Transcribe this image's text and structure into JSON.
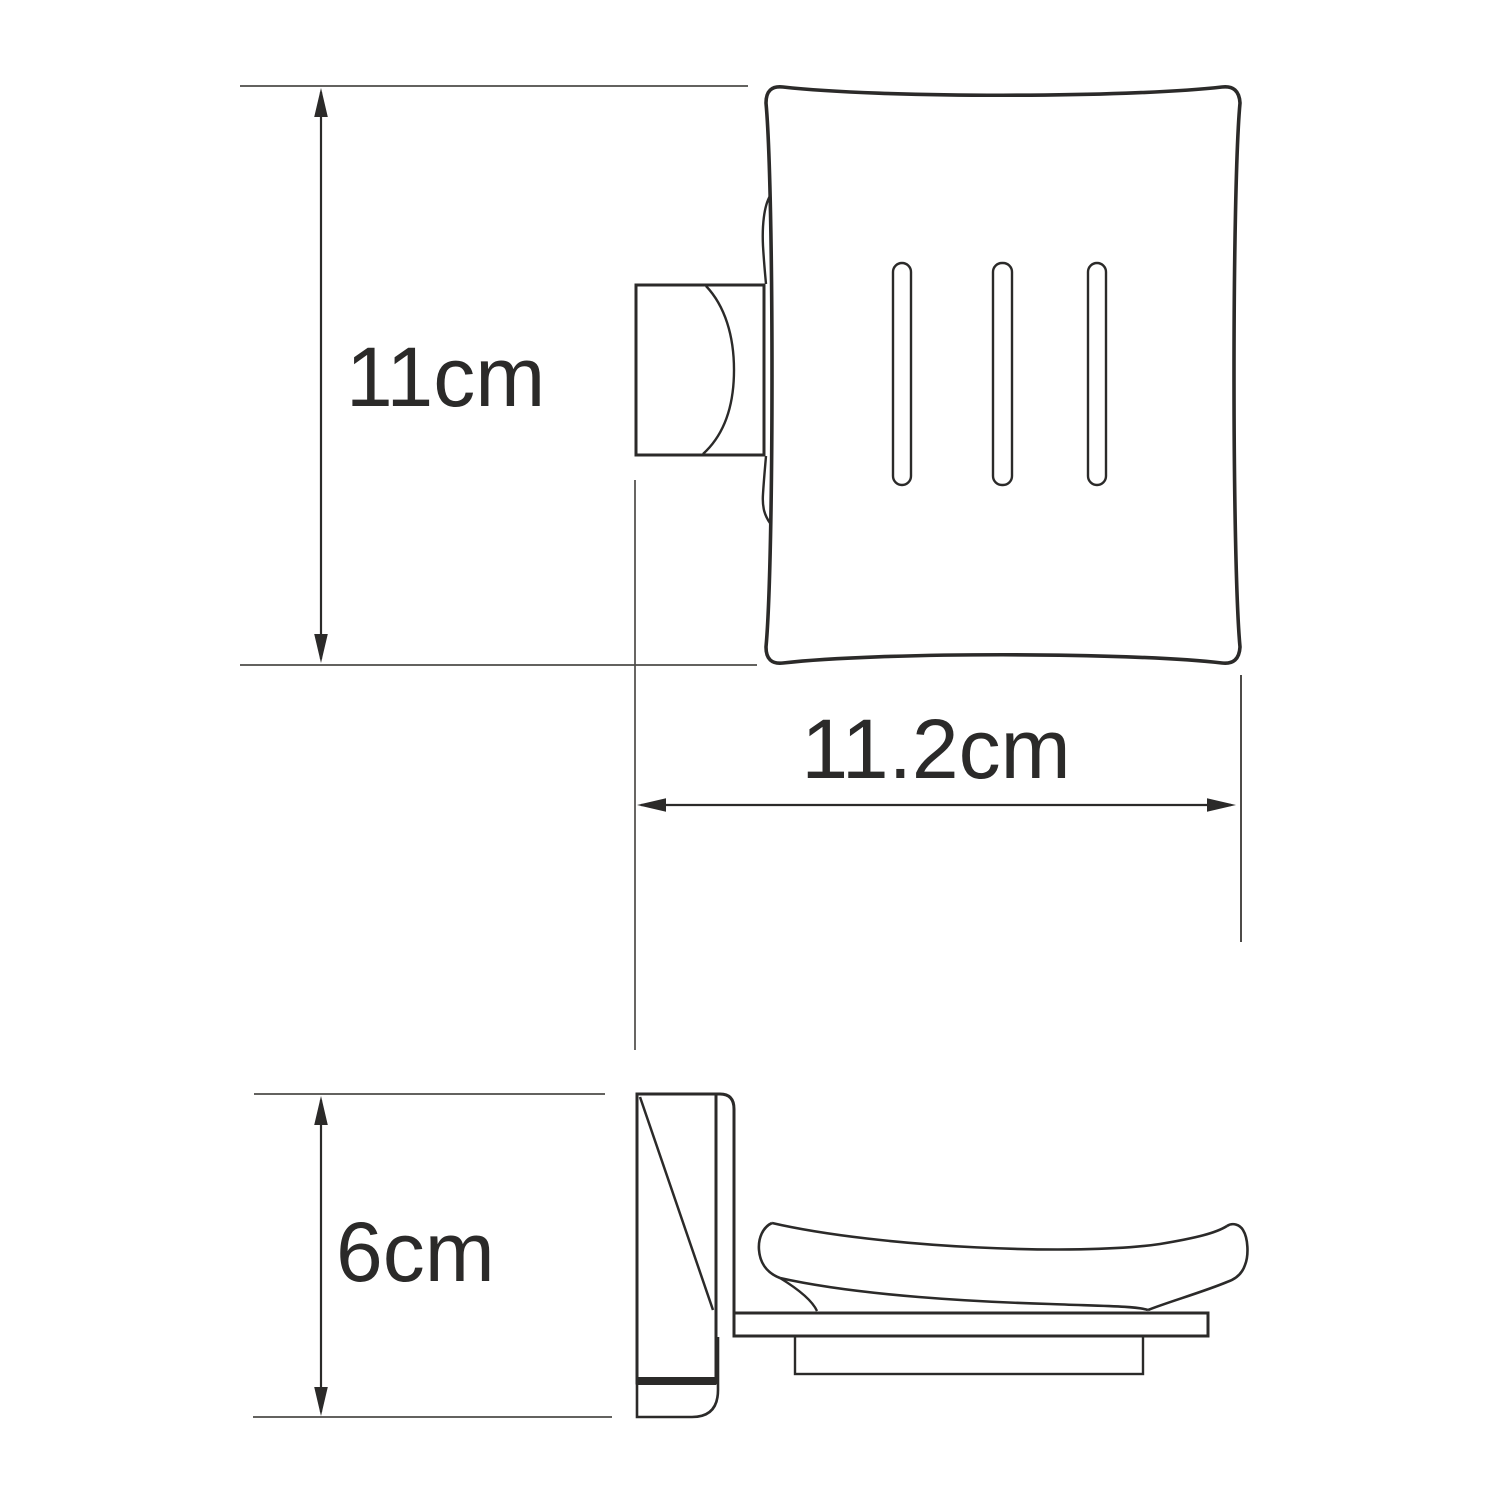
{
  "page": {
    "background": "#ffffff"
  },
  "drawing": {
    "kind": "dimensioned line drawing",
    "subject": "wall-mounted soap dish holder, front view and side view",
    "outline_color": "#2b2a29",
    "thin_line_color": "#4d4b48",
    "front_view": {
      "slot_count": 3
    },
    "dimensions": {
      "height": {
        "label": "11cm",
        "orientation": "vertical"
      },
      "depth": {
        "label": "11.2cm",
        "orientation": "horizontal"
      },
      "side_height": {
        "label": "6cm",
        "orientation": "vertical"
      }
    }
  }
}
